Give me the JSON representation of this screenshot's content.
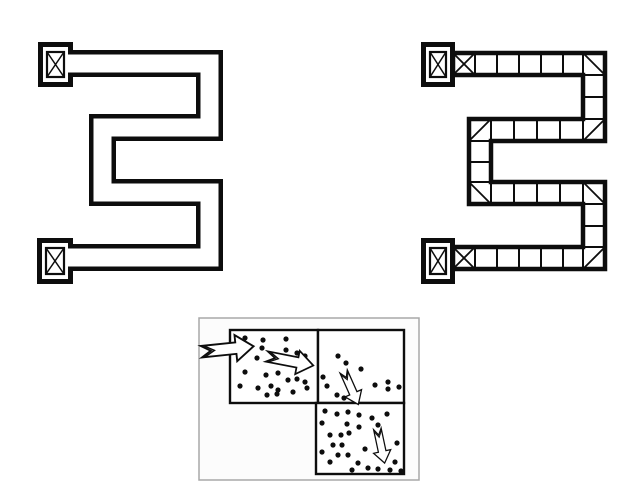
{
  "colors": {
    "ink": "#0d0d0d",
    "paper": "#ffffff",
    "frame_gray": "#a8a8a8",
    "flow_bg": "#fcfcfc"
  },
  "left_maze": {
    "name": "plain-corridor-maze",
    "corridor": {
      "centerline": [
        [
          64,
          63.5
        ],
        [
          209.5,
          63.5
        ],
        [
          209.5,
          127.5
        ],
        [
          102.5,
          127.5
        ],
        [
          102.5,
          192.5
        ],
        [
          209.5,
          192.5
        ],
        [
          209.5,
          257.5
        ],
        [
          64,
          257.5
        ]
      ],
      "outer_width": 27,
      "inner_width": 18
    },
    "boxes": [
      {
        "x": 38,
        "y": 42,
        "w": 35,
        "h": 45,
        "mark": "crossed"
      },
      {
        "x": 37,
        "y": 238,
        "w": 36,
        "h": 46,
        "mark": "crossed"
      }
    ]
  },
  "right_maze": {
    "name": "gridded-corridor-maze",
    "boundary_path": "M 453 53 H 605 V 141 H 491 V 182 H 605 V 269 H 453 V 247 H 583 V 204 H 469 V 119 H 583 V 75 H 453 Z",
    "cells": [
      {
        "x": 453,
        "y": 53,
        "w": 22,
        "h": 22,
        "mark": "x"
      },
      {
        "x": 475,
        "y": 53,
        "w": 22,
        "h": 22
      },
      {
        "x": 497,
        "y": 53,
        "w": 22,
        "h": 22
      },
      {
        "x": 519,
        "y": 53,
        "w": 22,
        "h": 22
      },
      {
        "x": 541,
        "y": 53,
        "w": 22,
        "h": 22
      },
      {
        "x": 563,
        "y": 53,
        "w": 20,
        "h": 22
      },
      {
        "x": 583,
        "y": 53,
        "w": 22,
        "h": 22,
        "mark": "nwse"
      },
      {
        "x": 583,
        "y": 75,
        "w": 22,
        "h": 22
      },
      {
        "x": 583,
        "y": 97,
        "w": 22,
        "h": 22
      },
      {
        "x": 469,
        "y": 119,
        "w": 22,
        "h": 22,
        "mark": "swne"
      },
      {
        "x": 491,
        "y": 119,
        "w": 23,
        "h": 22
      },
      {
        "x": 514,
        "y": 119,
        "w": 23,
        "h": 22
      },
      {
        "x": 537,
        "y": 119,
        "w": 23,
        "h": 22
      },
      {
        "x": 560,
        "y": 119,
        "w": 23,
        "h": 22
      },
      {
        "x": 583,
        "y": 119,
        "w": 22,
        "h": 22,
        "mark": "swne"
      },
      {
        "x": 469,
        "y": 141,
        "w": 22,
        "h": 21
      },
      {
        "x": 469,
        "y": 162,
        "w": 22,
        "h": 20
      },
      {
        "x": 469,
        "y": 182,
        "w": 22,
        "h": 22,
        "mark": "nwse"
      },
      {
        "x": 491,
        "y": 182,
        "w": 23,
        "h": 22
      },
      {
        "x": 514,
        "y": 182,
        "w": 23,
        "h": 22
      },
      {
        "x": 537,
        "y": 182,
        "w": 23,
        "h": 22
      },
      {
        "x": 560,
        "y": 182,
        "w": 23,
        "h": 22
      },
      {
        "x": 583,
        "y": 182,
        "w": 22,
        "h": 22,
        "mark": "nwse"
      },
      {
        "x": 583,
        "y": 204,
        "w": 22,
        "h": 22
      },
      {
        "x": 583,
        "y": 226,
        "w": 22,
        "h": 21
      },
      {
        "x": 453,
        "y": 247,
        "w": 22,
        "h": 22,
        "mark": "x"
      },
      {
        "x": 475,
        "y": 247,
        "w": 22,
        "h": 22
      },
      {
        "x": 497,
        "y": 247,
        "w": 22,
        "h": 22
      },
      {
        "x": 519,
        "y": 247,
        "w": 22,
        "h": 22
      },
      {
        "x": 541,
        "y": 247,
        "w": 22,
        "h": 22
      },
      {
        "x": 563,
        "y": 247,
        "w": 20,
        "h": 22
      },
      {
        "x": 583,
        "y": 247,
        "w": 22,
        "h": 22,
        "mark": "swne"
      }
    ],
    "boxes": [
      {
        "x": 421,
        "y": 42,
        "w": 34,
        "h": 45,
        "mark": "crossed"
      },
      {
        "x": 421,
        "y": 238,
        "w": 34,
        "h": 46,
        "mark": "crossed"
      }
    ]
  },
  "flow_image": {
    "name": "crowd-flow-illustration",
    "frame": {
      "x": 199,
      "y": 318,
      "w": 220,
      "h": 162
    },
    "squares": [
      {
        "x": 230,
        "y": 330,
        "w": 88,
        "h": 73
      },
      {
        "x": 318,
        "y": 330,
        "w": 86,
        "h": 73
      },
      {
        "x": 316,
        "y": 403,
        "w": 88,
        "h": 71
      }
    ],
    "dots": {
      "square_top_left": [
        [
          245,
          338
        ],
        [
          263,
          340
        ],
        [
          286,
          339
        ],
        [
          262,
          348
        ],
        [
          286,
          350
        ],
        [
          297,
          353
        ],
        [
          305,
          356
        ],
        [
          257,
          358
        ],
        [
          245,
          372
        ],
        [
          266,
          375
        ],
        [
          278,
          373
        ],
        [
          240,
          386
        ],
        [
          258,
          388
        ],
        [
          271,
          386
        ],
        [
          288,
          380
        ],
        [
          297,
          379
        ],
        [
          305,
          382
        ],
        [
          307,
          388
        ],
        [
          278,
          390
        ],
        [
          267,
          395
        ],
        [
          277,
          394
        ],
        [
          293,
          392
        ]
      ],
      "square_top_right": [
        [
          338,
          356
        ],
        [
          346,
          363
        ],
        [
          323,
          377
        ],
        [
          327,
          386
        ],
        [
          361,
          369
        ],
        [
          375,
          385
        ],
        [
          388,
          382
        ],
        [
          388,
          389
        ],
        [
          399,
          387
        ],
        [
          337,
          395
        ],
        [
          344,
          398
        ]
      ],
      "square_bottom_right": [
        [
          325,
          411
        ],
        [
          337,
          414
        ],
        [
          348,
          412
        ],
        [
          359,
          415
        ],
        [
          372,
          418
        ],
        [
          387,
          414
        ],
        [
          322,
          423
        ],
        [
          347,
          424
        ],
        [
          359,
          427
        ],
        [
          378,
          425
        ],
        [
          330,
          435
        ],
        [
          341,
          435
        ],
        [
          349,
          433
        ],
        [
          333,
          445
        ],
        [
          342,
          445
        ],
        [
          365,
          449
        ],
        [
          397,
          443
        ],
        [
          338,
          455
        ],
        [
          348,
          455
        ],
        [
          322,
          452
        ],
        [
          330,
          462
        ],
        [
          358,
          463
        ],
        [
          368,
          468
        ],
        [
          378,
          469
        ],
        [
          390,
          470
        ],
        [
          352,
          470
        ],
        [
          395,
          462
        ],
        [
          401,
          471
        ]
      ]
    },
    "arrows": [
      {
        "x": 227.5,
        "y": 349,
        "angle": -6,
        "scale": 1.05,
        "direction": "right"
      },
      {
        "x": 290,
        "y": 361,
        "angle": 11,
        "scale": 0.95,
        "direction": "right"
      },
      {
        "x": 351,
        "y": 388,
        "angle": 66,
        "scale": 0.72,
        "direction": "down"
      },
      {
        "x": 381,
        "y": 446,
        "angle": 78,
        "scale": 0.7,
        "direction": "down"
      }
    ],
    "dot_radius": 2.6
  }
}
